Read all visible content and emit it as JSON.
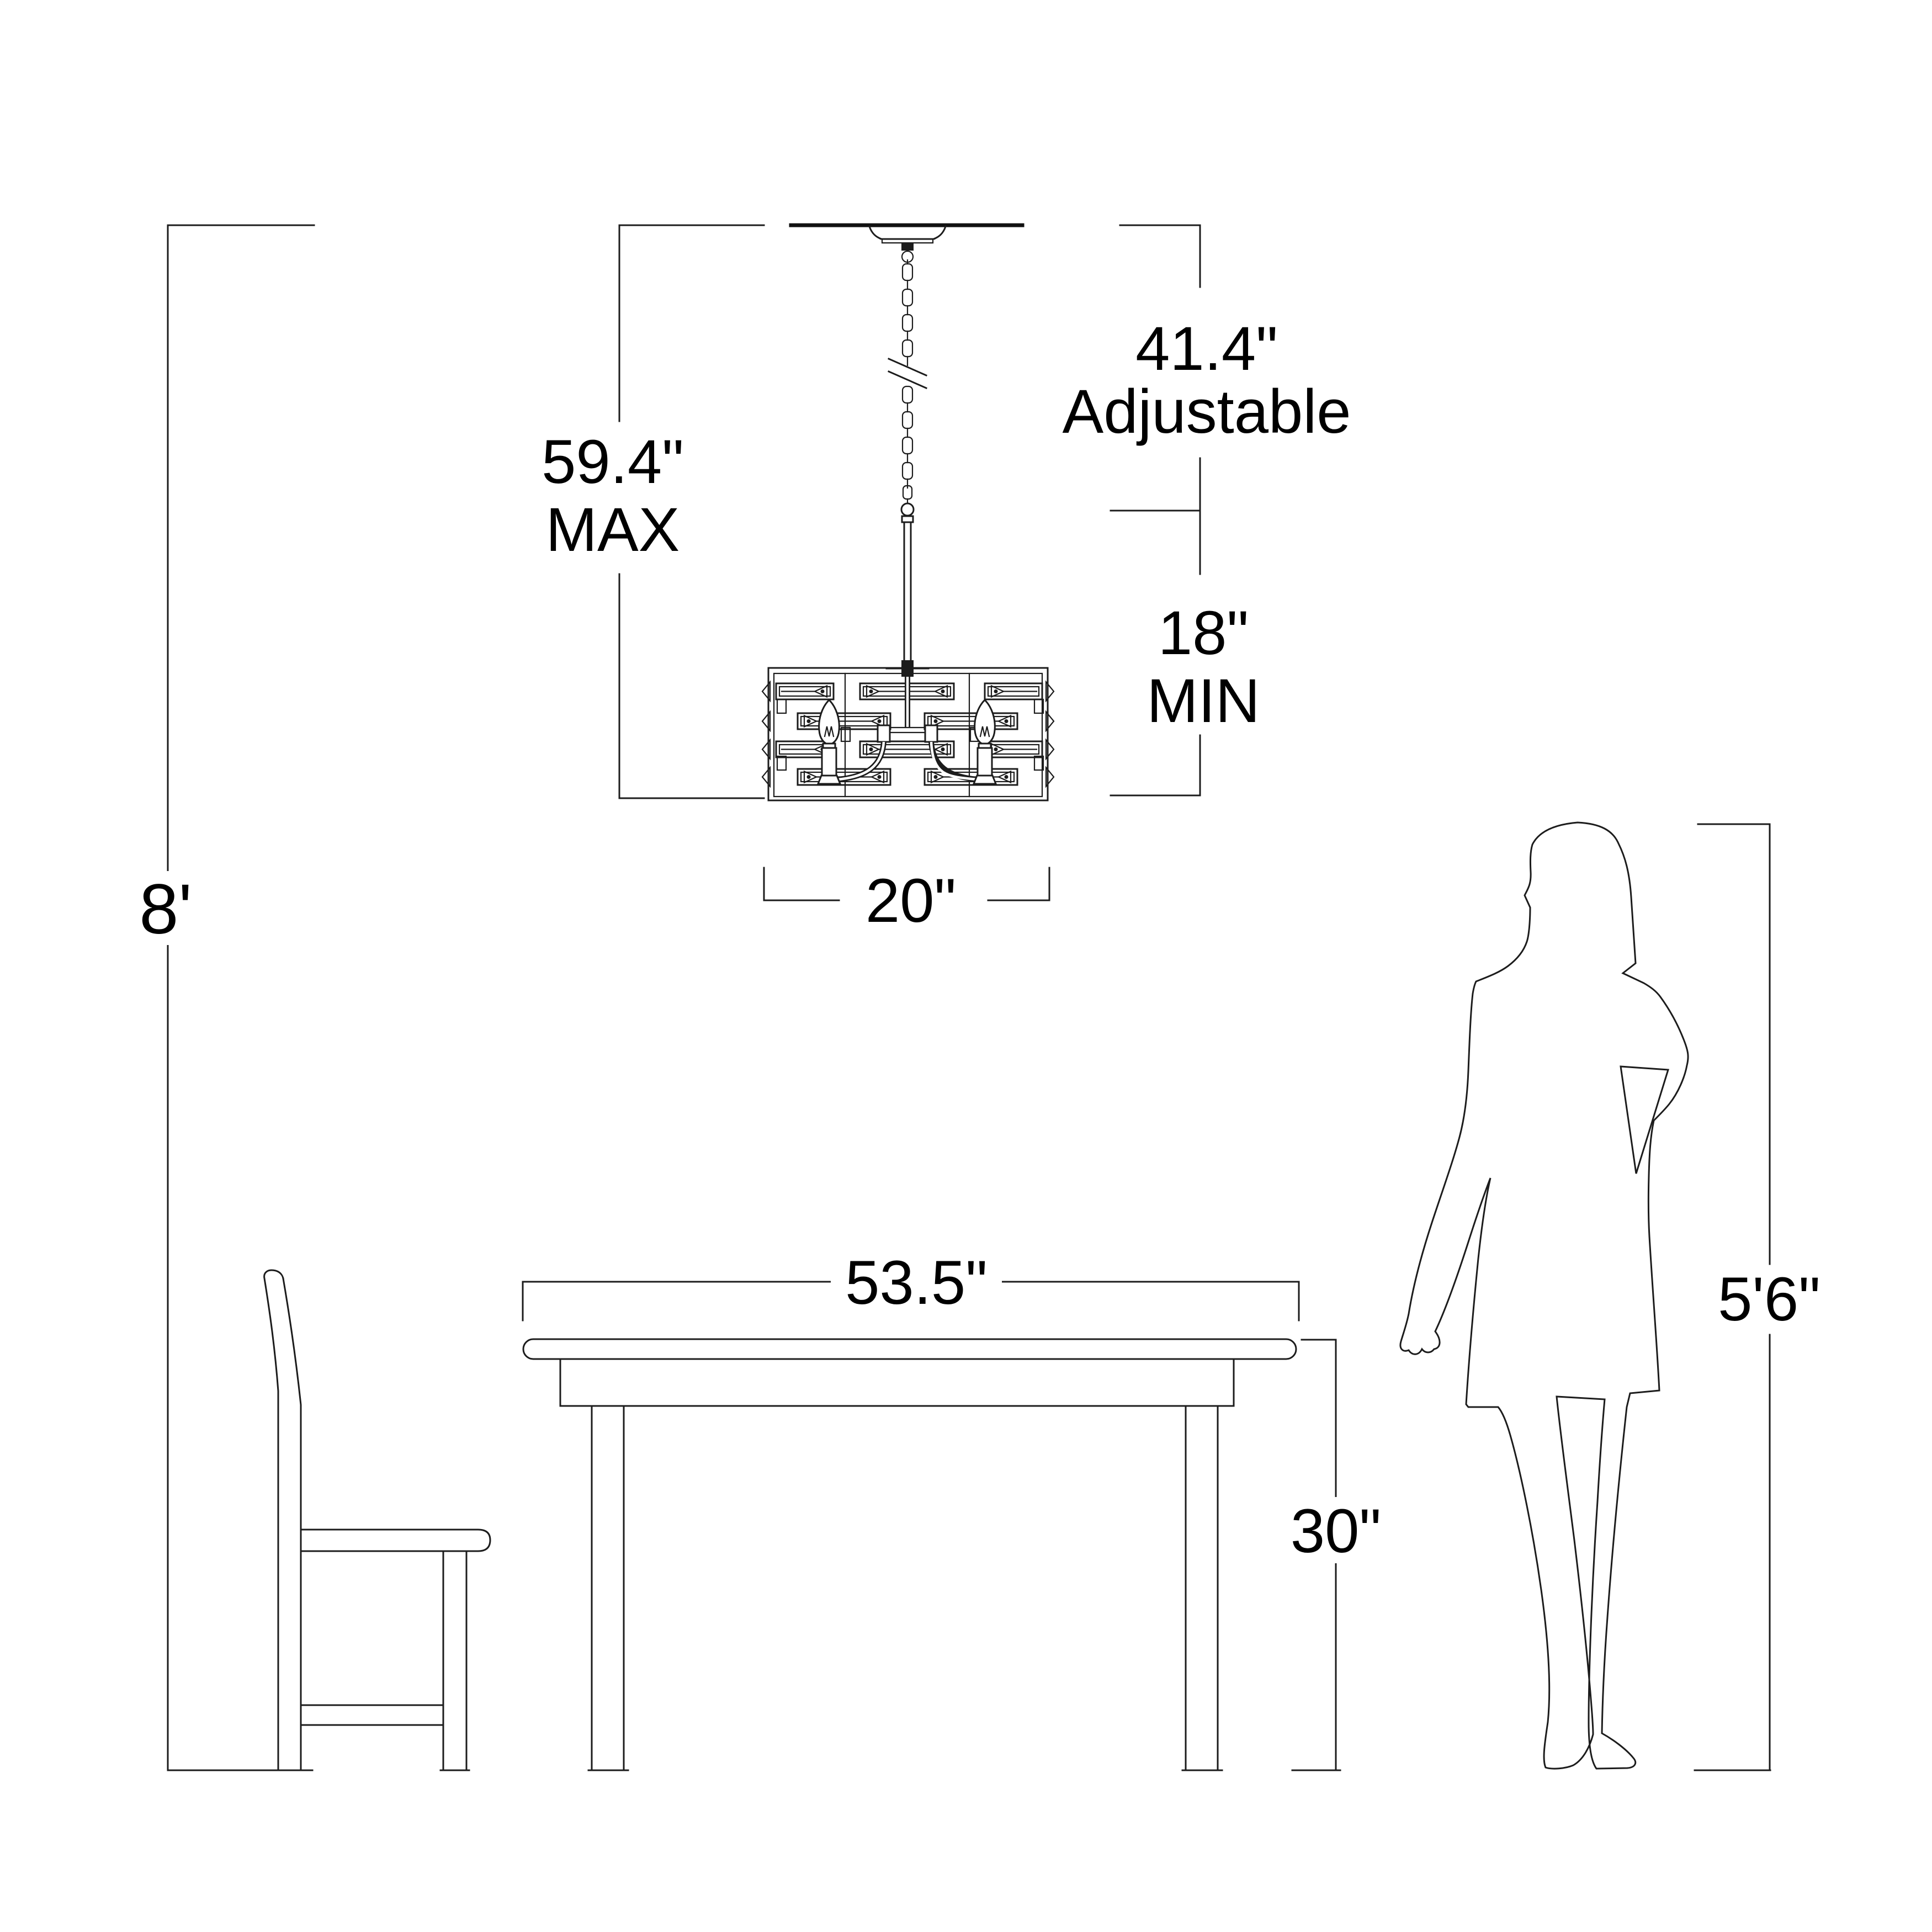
{
  "diagram": {
    "background_color": "#ffffff",
    "line_color": "#1c1c1c",
    "text_color": "#000000",
    "dimensions": {
      "ceiling_height": "8'",
      "fixture_overall_value": "59.4\"",
      "fixture_overall_qualifier": "MAX",
      "adjustable_value": "41.4\"",
      "adjustable_qualifier": "Adjustable",
      "min_value": "18\"",
      "min_qualifier": "MIN",
      "fixture_width": "20\"",
      "table_width": "53.5\"",
      "table_height": "30\"",
      "person_height": "5'6\""
    }
  }
}
